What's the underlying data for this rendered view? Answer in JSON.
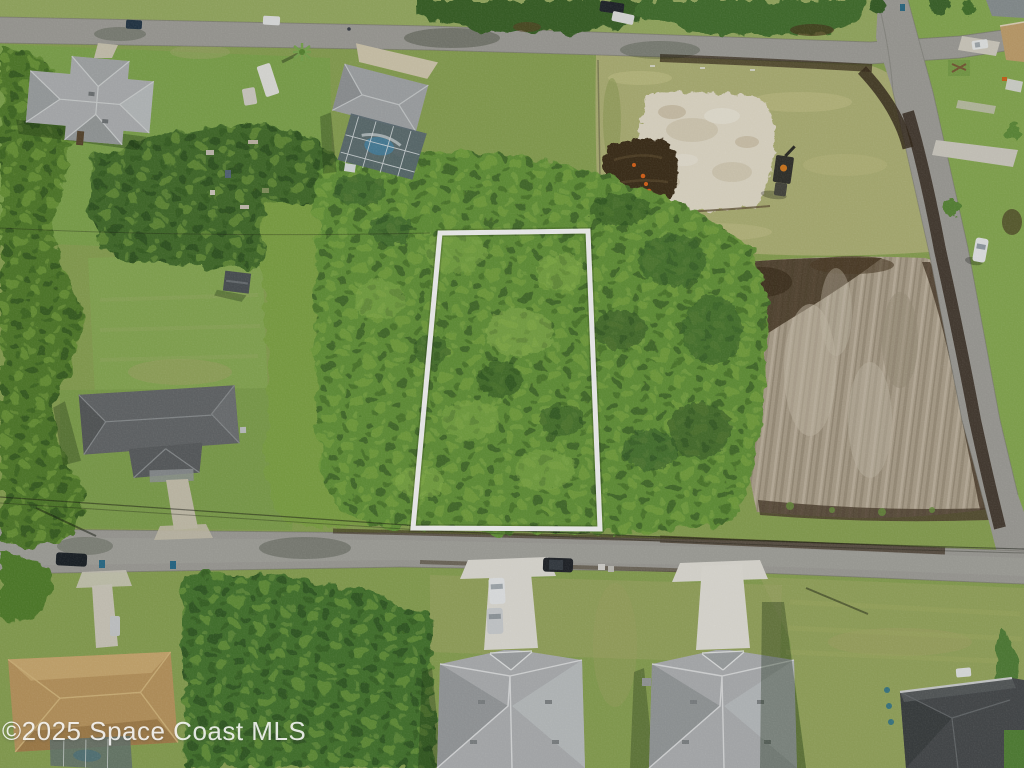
{
  "watermark": {
    "text": "©2025 Space Coast MLS"
  },
  "scene": {
    "kind": "aerial-drone-photo",
    "subject": "vacant wooded residential homesite outlined in white between two streets",
    "features": [
      {
        "name": "property-outline",
        "label": "white boundary lines of the listed vacant lot"
      },
      {
        "name": "street-north",
        "label": "paved street across top"
      },
      {
        "name": "street-south",
        "label": "paved street across bottom middle"
      },
      {
        "name": "street-east",
        "label": "paved street running down right side"
      },
      {
        "name": "cleared-lot-northeast",
        "label": "cleared pad with white sand, dark fill dirt, excavator and orange markers"
      },
      {
        "name": "cleared-lot-east",
        "label": "freshly scraped dirt lot beside east street"
      },
      {
        "name": "house-northwest",
        "label": "light gray hip-roof house with driveway"
      },
      {
        "name": "house-pool-enclosure",
        "label": "gray-roof house with screened pool enclosure"
      },
      {
        "name": "house-west",
        "label": "dark gray roof house with long driveway and rear lawn with shed"
      },
      {
        "name": "house-southwest",
        "label": "tan roof house with screened pool"
      },
      {
        "name": "house-south-left",
        "label": "new gray-roof house with concrete driveway and parked cars"
      },
      {
        "name": "house-south-right",
        "label": "new gray-roof house with concrete driveway"
      },
      {
        "name": "house-southeast",
        "label": "charcoal roof house at bottom right"
      },
      {
        "name": "vehicles",
        "label": "cars parked on streets and driveways"
      },
      {
        "name": "survey-mark",
        "label": "white zigzag survey mark near cleared pad"
      }
    ]
  },
  "colors": {
    "lawn_base": "#8fa857",
    "tree_mid": "#699a3d",
    "road_asphalt": "#a5a49e",
    "sand": "#eae3d1",
    "dirt_scraped": "#b4a893",
    "roof_light": "#b4b7b9",
    "roof_dark": "#696c6e",
    "roof_charcoal": "#4a4e50",
    "roof_tan": "#c19c63",
    "concrete": "#e8e6de",
    "pool_blue": "#4e86a2",
    "outline_white": "#ffffff"
  }
}
